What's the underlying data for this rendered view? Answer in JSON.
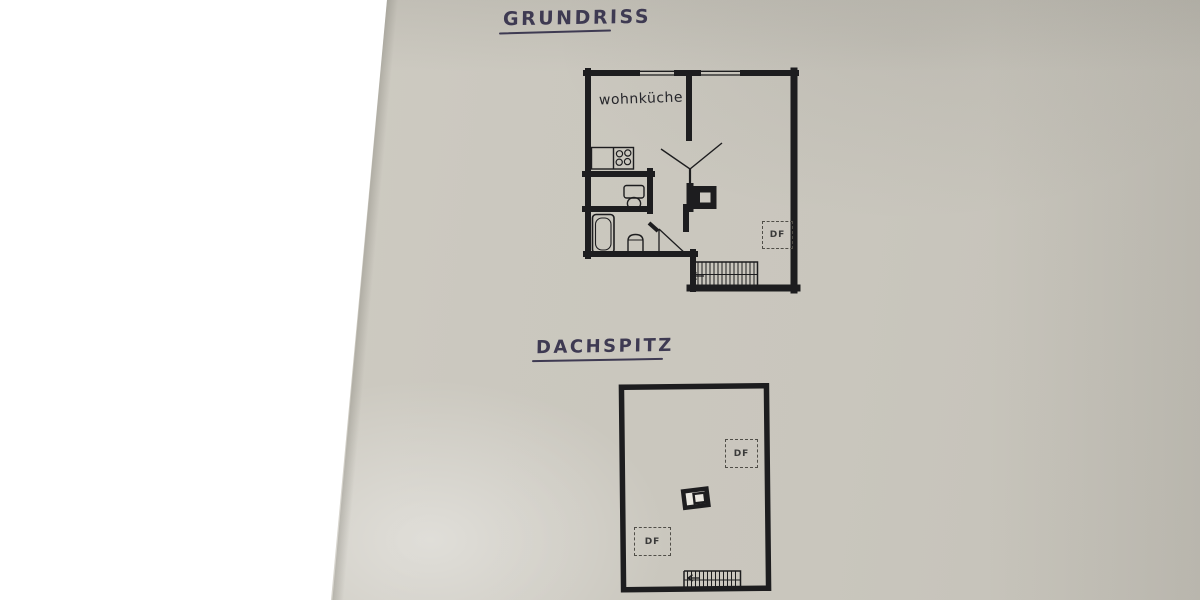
{
  "grundriss": {
    "title": "GRUNDRISS",
    "room_label": "wohnküche",
    "roof_window": {
      "label": "DF"
    },
    "drawn_symbols": [
      "exterior walls with two windows",
      "kitchen counter with 4-burner stove",
      "washbasin/WC",
      "bathtub",
      "toilet",
      "chimney",
      "double-door opening",
      "bath door swing",
      "staircase with direction arrow",
      "roof window DF"
    ]
  },
  "dachspitz": {
    "title": "DACHSPITZ",
    "roof_window_top": {
      "label": "DF"
    },
    "roof_window_bottom": {
      "label": "DF"
    },
    "drawn_symbols": [
      "rectangular attic outline",
      "chimney",
      "staircase with direction arrow",
      "two roof windows DF"
    ]
  },
  "colors": {
    "paper_gray": "#cbc8bf",
    "paper_white": "#ffffff",
    "plan_ink": "#1d1d1f",
    "title_ink": "#3e3a52"
  }
}
